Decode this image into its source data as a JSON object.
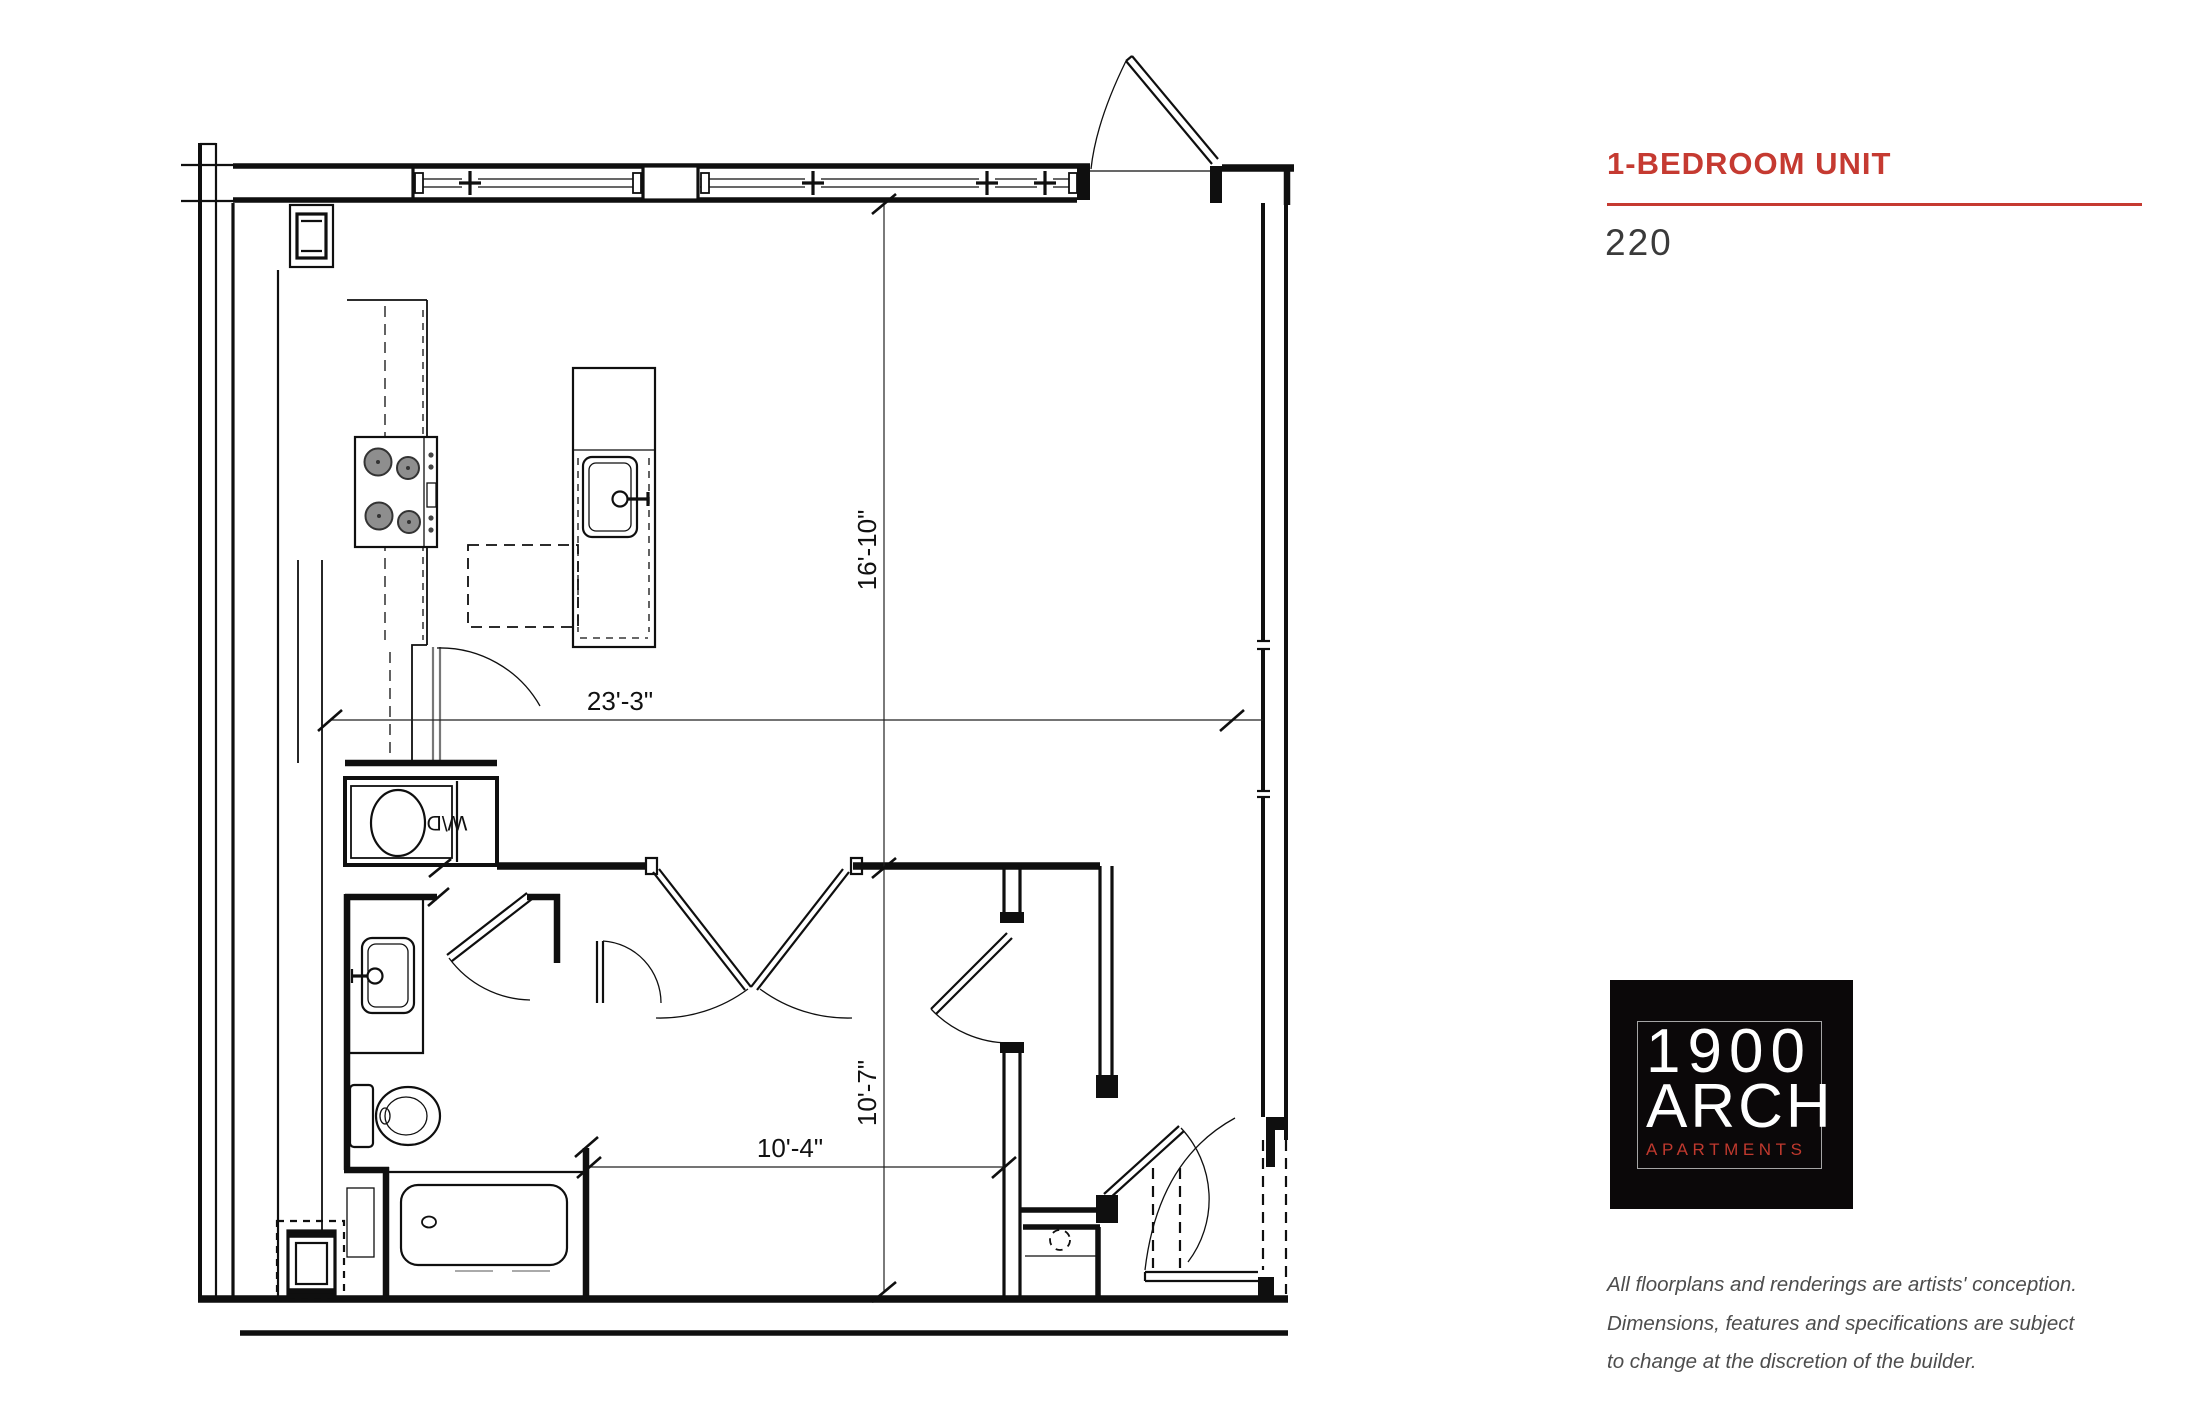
{
  "floorplan": {
    "dimensions": {
      "upper_vertical": "16'-10\"",
      "main_horizontal": "23'-3\"",
      "lower_vertical": "10'-7\"",
      "lower_horizontal": "10'-4\""
    },
    "labels": {
      "washer_dryer": "W\\D"
    }
  },
  "info_panel": {
    "title": "1-BEDROOM UNIT",
    "unit_number": "220",
    "logo": {
      "line1": "1900",
      "line2": "ARCH",
      "line3": "APARTMENTS"
    },
    "disclaimer": {
      "line1": "All floorplans and renderings are artists' conception.",
      "line2": "Dimensions, features and specifications are subject",
      "line3": "to change at the discretion of the builder."
    }
  },
  "colors": {
    "accent_red": "#c53a31",
    "logo_background": "#0b0809",
    "logo_red": "#c0392e",
    "unit_text": "#3a3a3a",
    "disclaimer_text": "#4d4d4d",
    "plan_line": "#0f0f0f",
    "burner_fill": "#8e8e8e"
  }
}
